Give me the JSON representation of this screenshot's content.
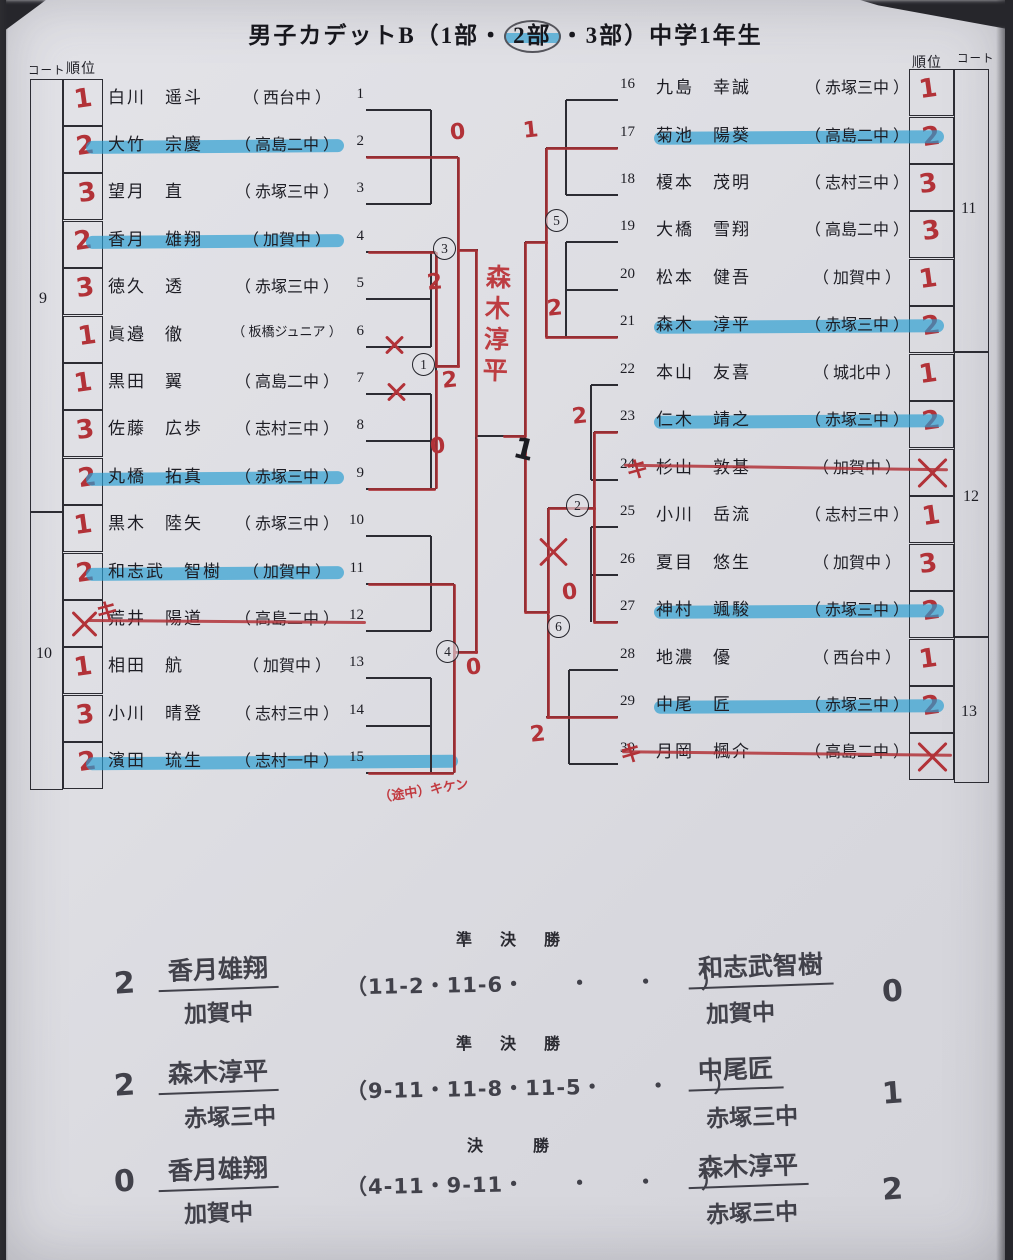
{
  "title": {
    "prefix": "男子カデットB（1部・",
    "circled": "2部",
    "suffix": "・3部）中学1年生"
  },
  "headers": {
    "left_court": "コート",
    "left_rank": "順位",
    "right_rank": "順位",
    "right_court": "コート"
  },
  "left_table": {
    "courts": [
      {
        "label": "9"
      },
      {
        "label": "10"
      }
    ]
  },
  "right_table": {
    "courts": [
      {
        "label": "11"
      },
      {
        "label": "12"
      },
      {
        "label": "13"
      }
    ]
  },
  "players_left": [
    {
      "num": "1",
      "name": "白川　遥斗",
      "school": "西台中",
      "rank": "1",
      "highlight": false,
      "struck": false
    },
    {
      "num": "2",
      "name": "大竹　宗慶",
      "school": "高島二中",
      "rank": "2",
      "highlight": true,
      "struck": false
    },
    {
      "num": "3",
      "name": "望月　直",
      "school": "赤塚三中",
      "rank": "3",
      "highlight": false,
      "struck": false
    },
    {
      "num": "4",
      "name": "香月　雄翔",
      "school": "加賀中",
      "rank": "2",
      "highlight": true,
      "struck": false
    },
    {
      "num": "5",
      "name": "徳久　透",
      "school": "赤塚三中",
      "rank": "3",
      "highlight": false,
      "struck": false
    },
    {
      "num": "6",
      "name": "眞邉　徹",
      "school": "板橋ジュニア",
      "rank": "1",
      "highlight": false,
      "struck": false
    },
    {
      "num": "7",
      "name": "黒田　翼",
      "school": "高島二中",
      "rank": "1",
      "highlight": false,
      "struck": false
    },
    {
      "num": "8",
      "name": "佐藤　広歩",
      "school": "志村三中",
      "rank": "3",
      "highlight": false,
      "struck": false
    },
    {
      "num": "9",
      "name": "丸橋　拓真",
      "school": "赤塚三中",
      "rank": "2",
      "highlight": true,
      "struck": false
    },
    {
      "num": "10",
      "name": "黒木　陸矢",
      "school": "赤塚三中",
      "rank": "1",
      "highlight": false,
      "struck": false
    },
    {
      "num": "11",
      "name": "和志武　智樹",
      "school": "加賀中",
      "rank": "2",
      "highlight": true,
      "struck": false
    },
    {
      "num": "12",
      "name": "荒井　陽道",
      "school": "高島二中",
      "rank": "X",
      "highlight": false,
      "struck": true
    },
    {
      "num": "13",
      "name": "相田　航",
      "school": "加賀中",
      "rank": "1",
      "highlight": false,
      "struck": false
    },
    {
      "num": "14",
      "name": "小川　晴登",
      "school": "志村三中",
      "rank": "3",
      "highlight": false,
      "struck": false
    },
    {
      "num": "15",
      "name": "濱田　琉生",
      "school": "志村一中",
      "rank": "2",
      "highlight": true,
      "struck": false
    }
  ],
  "players_right": [
    {
      "num": "16",
      "name": "九島　幸誠",
      "school": "赤塚三中",
      "rank": "1",
      "highlight": false,
      "struck": false
    },
    {
      "num": "17",
      "name": "菊池　陽葵",
      "school": "高島二中",
      "rank": "2",
      "highlight": true,
      "struck": false
    },
    {
      "num": "18",
      "name": "榎本　茂明",
      "school": "志村三中",
      "rank": "3",
      "highlight": false,
      "struck": false
    },
    {
      "num": "19",
      "name": "大橋　雪翔",
      "school": "高島二中",
      "rank": "3",
      "highlight": false,
      "struck": false
    },
    {
      "num": "20",
      "name": "松本　健吾",
      "school": "加賀中",
      "rank": "1",
      "highlight": false,
      "struck": false
    },
    {
      "num": "21",
      "name": "森木　淳平",
      "school": "赤塚三中",
      "rank": "2",
      "highlight": true,
      "struck": false
    },
    {
      "num": "22",
      "name": "本山　友喜",
      "school": "城北中",
      "rank": "1",
      "highlight": false,
      "struck": false
    },
    {
      "num": "23",
      "name": "仁木　靖之",
      "school": "赤塚三中",
      "rank": "2",
      "highlight": true,
      "struck": false
    },
    {
      "num": "24",
      "name": "杉山　敦基",
      "school": "加賀中",
      "rank": "X",
      "highlight": false,
      "struck": true
    },
    {
      "num": "25",
      "name": "小川　岳流",
      "school": "志村三中",
      "rank": "1",
      "highlight": false,
      "struck": false
    },
    {
      "num": "26",
      "name": "夏目　悠生",
      "school": "加賀中",
      "rank": "3",
      "highlight": false,
      "struck": false
    },
    {
      "num": "27",
      "name": "神村　颯駿",
      "school": "赤塚三中",
      "rank": "2",
      "highlight": true,
      "struck": false
    },
    {
      "num": "28",
      "name": "地濃　優",
      "school": "西台中",
      "rank": "1",
      "highlight": false,
      "struck": false
    },
    {
      "num": "29",
      "name": "中尾　匠",
      "school": "赤塚三中",
      "rank": "2",
      "highlight": true,
      "struck": false
    },
    {
      "num": "30",
      "name": "月岡　楓介",
      "school": "高島二中",
      "rank": "X",
      "highlight": false,
      "struck": true
    }
  ],
  "bracket": {
    "match_circles": [
      {
        "label": "1",
        "x": 406,
        "y": 353
      },
      {
        "label": "2",
        "x": 560,
        "y": 494
      },
      {
        "label": "3",
        "x": 427,
        "y": 237
      },
      {
        "label": "4",
        "x": 430,
        "y": 640
      },
      {
        "label": "5",
        "x": 539,
        "y": 209
      },
      {
        "label": "6",
        "x": 541,
        "y": 615
      }
    ],
    "champion_name": "森木淳平",
    "score_notes": [
      {
        "t": "0",
        "x": 444,
        "y": 120
      },
      {
        "t": "1",
        "x": 517,
        "y": 118
      },
      {
        "t": "2",
        "x": 421,
        "y": 270
      },
      {
        "t": "2",
        "x": 436,
        "y": 368
      },
      {
        "t": "0",
        "x": 424,
        "y": 434
      },
      {
        "t": "0",
        "x": 460,
        "y": 655
      },
      {
        "t": "2",
        "x": 541,
        "y": 296
      },
      {
        "t": "2",
        "x": 566,
        "y": 404
      },
      {
        "t": "0",
        "x": 556,
        "y": 580
      },
      {
        "t": "2",
        "x": 524,
        "y": 722
      },
      {
        "t": "キ",
        "x": 90,
        "y": 594
      },
      {
        "t": "キ",
        "x": 620,
        "y": 452
      },
      {
        "t": "キ",
        "x": 614,
        "y": 736
      }
    ],
    "retire_note": "（途中）キケン",
    "pen_mark": "1"
  },
  "results": {
    "matches": [
      {
        "heading": "準　決　勝",
        "left_score": "2",
        "left_name": "香月雄翔",
        "left_school": "加賀中",
        "games": "（11-2・11-6・　　・　　・　　）",
        "right_name": "和志武智樹",
        "right_school": "加賀中",
        "right_score": "0"
      },
      {
        "heading": "準　決　勝",
        "left_score": "2",
        "left_name": "森木淳平",
        "left_school": "赤塚三中",
        "games": "（9-11・11-8・11-5・　　・　　）",
        "right_name": "中尾匠",
        "right_school": "赤塚三中",
        "right_score": "1"
      },
      {
        "heading": "決　　勝",
        "left_score": "0",
        "left_name": "香月雄翔",
        "left_school": "加賀中",
        "games": "（4-11・9-11・　　・　　・　　）",
        "right_name": "森木淳平",
        "right_school": "赤塚三中",
        "right_score": "2"
      }
    ]
  }
}
